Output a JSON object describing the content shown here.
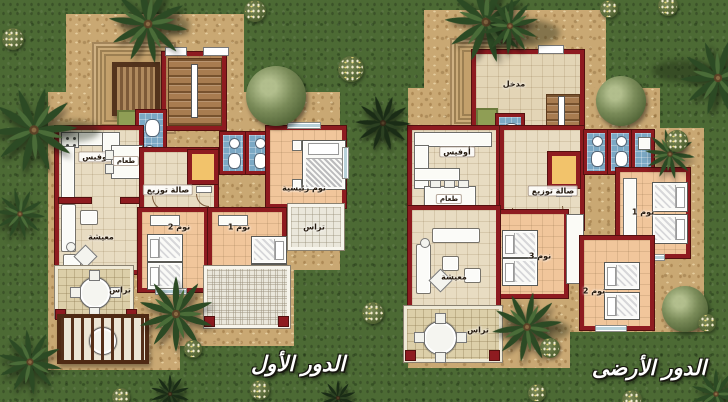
{
  "palette": {
    "grass": "#4c6a34",
    "sand": "#c9a873",
    "wall_red": "#8e1b20",
    "wall_dark": "#54100f",
    "cream_floor": "#e8dcc2",
    "bedroom_floor": "#f1c69b",
    "bath_blue": "#7ba8c4",
    "elevator_yellow": "#f2c36b",
    "terrace_white": "#eae7db",
    "court_sand": "#dccfa9",
    "stair_brown": "#a87c50",
    "balcony_frame": "#4f2a14",
    "planter_green": "#8f9e55",
    "palm_green": "#2c4a24"
  },
  "plans": {
    "first_floor": {
      "caption": "الدور الأول",
      "labels": {
        "office": "أوفيس",
        "dining": "طعام",
        "hall": "صالة توزيع",
        "master_bedroom": "نوم رئيسية",
        "bedroom_1": "نوم 1",
        "bedroom_2": "نوم 2",
        "living": "معيشة",
        "terrace_side": "تراس",
        "terrace_court": "تراس"
      }
    },
    "ground_floor": {
      "caption": "الدور الأرضى",
      "labels": {
        "entrance": "مدخل",
        "office": "أوفيس",
        "dining": "طعام",
        "hall": "صالة توزيع",
        "living": "معيشة",
        "bedroom_1": "نوم 1",
        "bedroom_2": "نوم 2",
        "bedroom_3": "نوم 3",
        "terrace": "تراس"
      }
    }
  }
}
